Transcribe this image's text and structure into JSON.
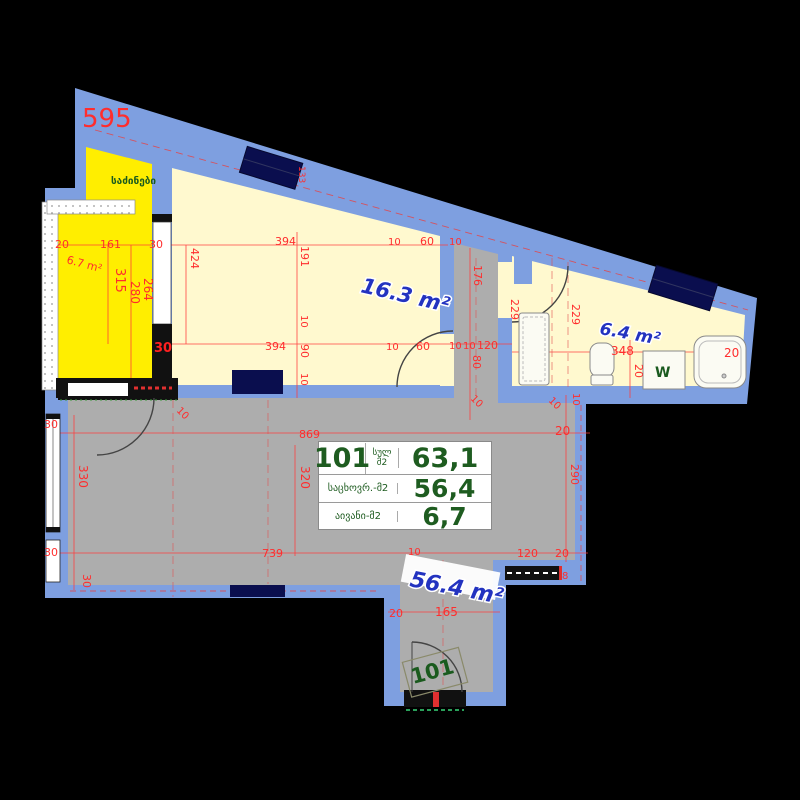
{
  "title": "Apartment 101 floor plan",
  "colors": {
    "wall": "#7E9FE0",
    "window_glass": "#0A0E4E",
    "balcony_fill": "#FFEE00",
    "room_fill": "#FFF9CF",
    "living_fill": "#ADADAD",
    "dim_red": "#FF2D2D",
    "area_label_blue": "#2333C0",
    "table_green": "#1E5C20",
    "background": "#000000"
  },
  "info_table": {
    "number": "101",
    "total_label": "სულ",
    "total_unit": "მ2",
    "total_value": "63,1",
    "living_label": "საცხოვრ.-მ2",
    "living_value": "56,4",
    "balcony_label": "აივანი-მ2",
    "balcony_value": "6,7"
  },
  "room_labels": [
    {
      "t": "საძინები",
      "x": 111,
      "y": 184,
      "cls": "g",
      "s": 10,
      "r": 0
    },
    {
      "t": "16.3 m²",
      "x": 360,
      "y": 292,
      "cls": "b",
      "s": 21,
      "r": 13
    },
    {
      "t": "6.4 m²",
      "x": 599,
      "y": 334,
      "cls": "b",
      "s": 17,
      "r": 10
    },
    {
      "t": "56.4 m²",
      "x": 409,
      "y": 586,
      "cls": "b",
      "s": 22,
      "r": 11
    },
    {
      "t": "6.7 m²",
      "x": 66,
      "y": 263,
      "cls": "dim",
      "s": 11,
      "r": 15
    },
    {
      "t": "W",
      "x": 655,
      "y": 377,
      "cls": "g",
      "s": 14,
      "r": 0
    },
    {
      "t": "101",
      "x": 413,
      "y": 684,
      "cls": "g101",
      "s": 21,
      "r": -15
    }
  ],
  "dimensions": [
    {
      "t": "595",
      "x": 82,
      "y": 127,
      "s": 26
    },
    {
      "t": "20",
      "x": 55,
      "y": 248
    },
    {
      "t": "161",
      "x": 100,
      "y": 248
    },
    {
      "t": "30",
      "x": 149,
      "y": 248
    },
    {
      "t": "315",
      "x": 116,
      "y": 268,
      "r": 90,
      "s": 13
    },
    {
      "t": "280",
      "x": 131,
      "y": 281,
      "r": 90,
      "s": 12
    },
    {
      "t": "264",
      "x": 144,
      "y": 278,
      "r": 90,
      "s": 12
    },
    {
      "t": "424",
      "x": 191,
      "y": 248,
      "r": 90
    },
    {
      "t": "133",
      "x": 299,
      "y": 166,
      "r": 90,
      "s": 9
    },
    {
      "t": "394",
      "x": 275,
      "y": 245
    },
    {
      "t": "10",
      "x": 388,
      "y": 245,
      "s": 10
    },
    {
      "t": "60",
      "x": 420,
      "y": 245
    },
    {
      "t": "191",
      "x": 301,
      "y": 246,
      "r": 90
    },
    {
      "t": "10",
      "x": 301,
      "y": 315,
      "r": 90,
      "s": 10
    },
    {
      "t": "90",
      "x": 301,
      "y": 344,
      "r": 90
    },
    {
      "t": "10",
      "x": 301,
      "y": 373,
      "r": 90,
      "s": 10
    },
    {
      "t": "394",
      "x": 265,
      "y": 350
    },
    {
      "t": "10",
      "x": 386,
      "y": 350,
      "s": 10
    },
    {
      "t": "60",
      "x": 416,
      "y": 350
    },
    {
      "t": "30",
      "x": 154,
      "y": 352,
      "s": 13,
      "cls": "dimb"
    },
    {
      "t": "10",
      "x": 449,
      "y": 245,
      "s": 10
    },
    {
      "t": "176",
      "x": 474,
      "y": 265,
      "r": 90
    },
    {
      "t": "229",
      "x": 511,
      "y": 299,
      "r": 90
    },
    {
      "t": "10",
      "x": 449,
      "y": 349,
      "s": 10
    },
    {
      "t": "10",
      "x": 463,
      "y": 349,
      "s": 10
    },
    {
      "t": "120",
      "x": 477,
      "y": 349
    },
    {
      "t": "80",
      "x": 473,
      "y": 355,
      "r": 90
    },
    {
      "t": "10",
      "x": 470,
      "y": 399,
      "r": 45,
      "s": 10
    },
    {
      "t": "229",
      "x": 572,
      "y": 304,
      "r": 90
    },
    {
      "t": "348",
      "x": 611,
      "y": 355,
      "s": 12
    },
    {
      "t": "20",
      "x": 635,
      "y": 364,
      "r": 90
    },
    {
      "t": "20",
      "x": 724,
      "y": 357,
      "s": 12
    },
    {
      "t": "10",
      "x": 548,
      "y": 401,
      "r": 45,
      "s": 10
    },
    {
      "t": "30",
      "x": 44,
      "y": 428
    },
    {
      "t": "10",
      "x": 176,
      "y": 411,
      "r": 45,
      "s": 10
    },
    {
      "t": "869",
      "x": 299,
      "y": 438
    },
    {
      "t": "320",
      "x": 301,
      "y": 466,
      "r": 90,
      "s": 12
    },
    {
      "t": "330",
      "x": 79,
      "y": 465,
      "r": 90,
      "s": 12
    },
    {
      "t": "739",
      "x": 262,
      "y": 557
    },
    {
      "t": "10",
      "x": 408,
      "y": 555,
      "s": 10
    },
    {
      "t": "120",
      "x": 517,
      "y": 557
    },
    {
      "t": "20",
      "x": 555,
      "y": 557
    },
    {
      "t": "30",
      "x": 44,
      "y": 556
    },
    {
      "t": "30",
      "x": 83,
      "y": 574,
      "r": 90,
      "s": 11
    },
    {
      "t": "10",
      "x": 573,
      "y": 393,
      "r": 90,
      "s": 10
    },
    {
      "t": "20",
      "x": 555,
      "y": 435,
      "s": 12
    },
    {
      "t": "290",
      "x": 571,
      "y": 464,
      "r": 90
    },
    {
      "t": "8",
      "x": 562,
      "y": 579,
      "s": 10
    },
    {
      "t": "20",
      "x": 389,
      "y": 617
    },
    {
      "t": "165",
      "x": 435,
      "y": 616,
      "s": 12
    }
  ]
}
